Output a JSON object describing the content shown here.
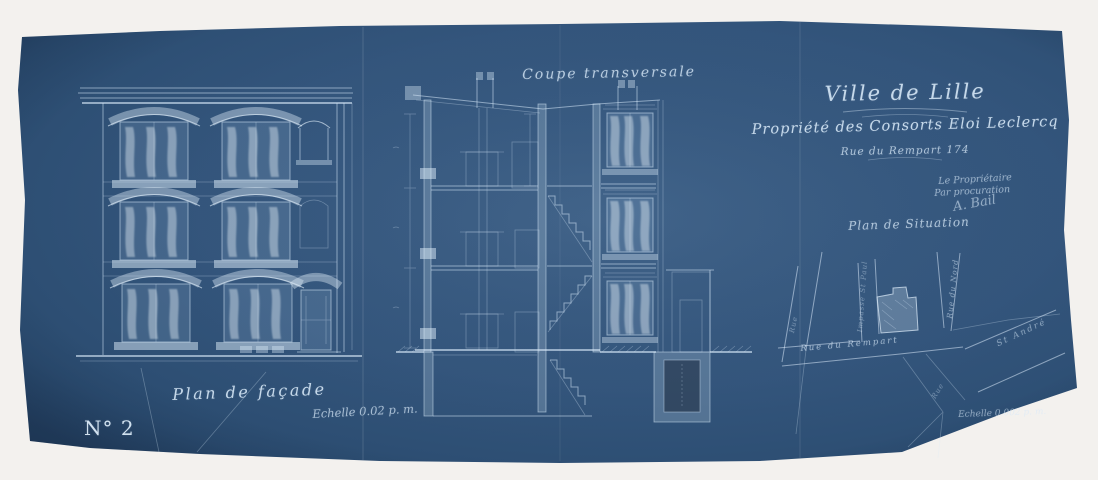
{
  "sheet": {
    "number": "N° 2"
  },
  "title_block": {
    "city": "Ville de Lille",
    "property_line": "Propriété des Consorts Eloi Leclercq",
    "address_line": "Rue du Rempart 174",
    "approval_line1": "Le Propriétaire",
    "approval_line2": "Par procuration",
    "signature": "A. Bail"
  },
  "drawings": {
    "section": {
      "title": "Coupe transversale"
    },
    "facade": {
      "title": "Plan de façade",
      "scale": "Echelle 0.02 p. m."
    },
    "situation": {
      "title": "Plan de Situation",
      "scale": "Echelle 0.002 p. m."
    }
  },
  "site_plan": {
    "streets": [
      {
        "name": "Rue du Rempart"
      },
      {
        "name": "Impasse St Paul"
      },
      {
        "name": "Rue du Nord"
      },
      {
        "name": "St André"
      },
      {
        "name": "Rue"
      },
      {
        "name": "Rue"
      }
    ]
  },
  "colors": {
    "paper": "#33557c",
    "paper_edge": "#274766",
    "background": "#f3f1ee",
    "ink": "#d6e7f7"
  }
}
